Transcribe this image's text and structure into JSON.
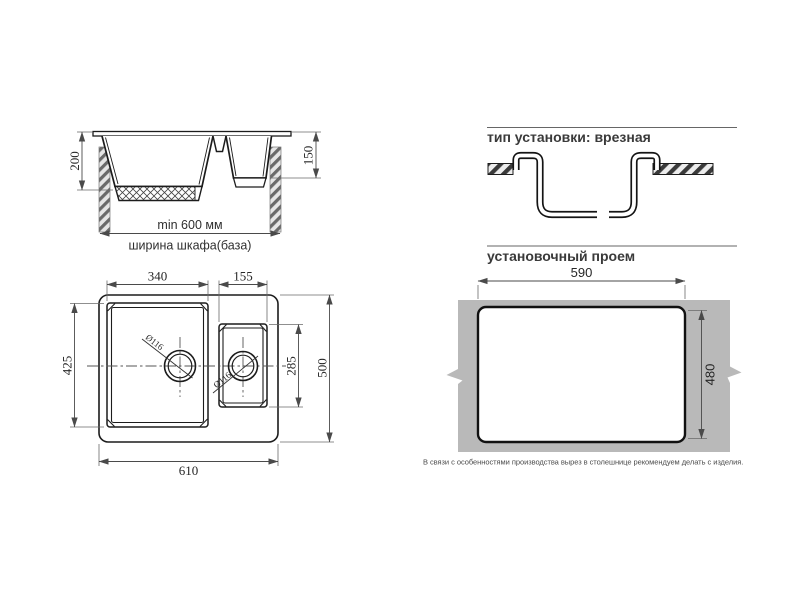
{
  "colors": {
    "background": "#ffffff",
    "line": "#1c1c1c",
    "dim_line": "#4a4a4a",
    "text": "#2f2f2f",
    "countertop_gray": "#b9b9b9"
  },
  "section_view": {
    "dim_depth_main_bowl": "200",
    "dim_depth_small_bowl": "150",
    "dim_cabinet_width_min": "min 600 мм",
    "dim_cabinet_width_label": "ширина шкафа(база)"
  },
  "installation_type": {
    "title": "тип установки: врезная"
  },
  "plan_view": {
    "dim_main_bowl_width": "340",
    "dim_small_bowl_width": "155",
    "dim_main_bowl_length": "425",
    "dim_small_bowl_length": "285",
    "dim_overall_depth": "500",
    "dim_overall_width": "610",
    "drain_main_diameter": "Ø116",
    "drain_small_diameter": "Ø116"
  },
  "installation_opening": {
    "title": "установочный проем",
    "dim_width": "590",
    "dim_height": "480",
    "note": "В связи с особенностями производства вырез в столешнице рекомендуем делать с изделия."
  }
}
